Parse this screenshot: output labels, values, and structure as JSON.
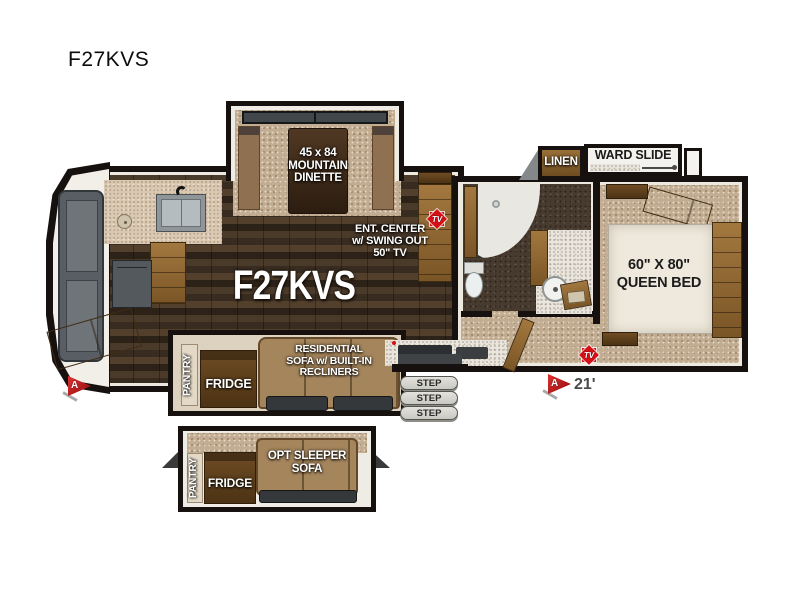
{
  "page": {
    "title": "F27KVS"
  },
  "colors": {
    "accent_red": "#d40f16",
    "wall": "#16110e",
    "cabinet_wood": "#8a6434",
    "carpet": "#c2ad92",
    "counter": "#e9e5dc"
  },
  "floorplan": {
    "floor_model": "F27KVS",
    "length": "21'",
    "tv_badge": "TV",
    "awning_marker": "A",
    "dinette": {
      "l1": "45 x 84",
      "l2": "MOUNTAIN",
      "l3": "DINETTE"
    },
    "ent_center": {
      "l1": "ENT. CENTER",
      "l2": "w/ SWING OUT",
      "l3": "50\" TV"
    },
    "sofa": {
      "l1": "RESIDENTIAL",
      "l2": "SOFA w/ BUILT-IN",
      "l3": "RECLINERS"
    },
    "bed": {
      "l1": "60\" X 80\"",
      "l2": "QUEEN BED"
    },
    "linen": "LINEN",
    "ward_slide": "WARD SLIDE",
    "pantry": "PANTRY",
    "fridge": "FRIDGE",
    "steps": [
      "STEP",
      "STEP",
      "STEP"
    ],
    "inset": {
      "pantry": "PANTRY",
      "fridge": "FRIDGE",
      "sofa_l1": "OPT SLEEPER",
      "sofa_l2": "SOFA"
    }
  }
}
